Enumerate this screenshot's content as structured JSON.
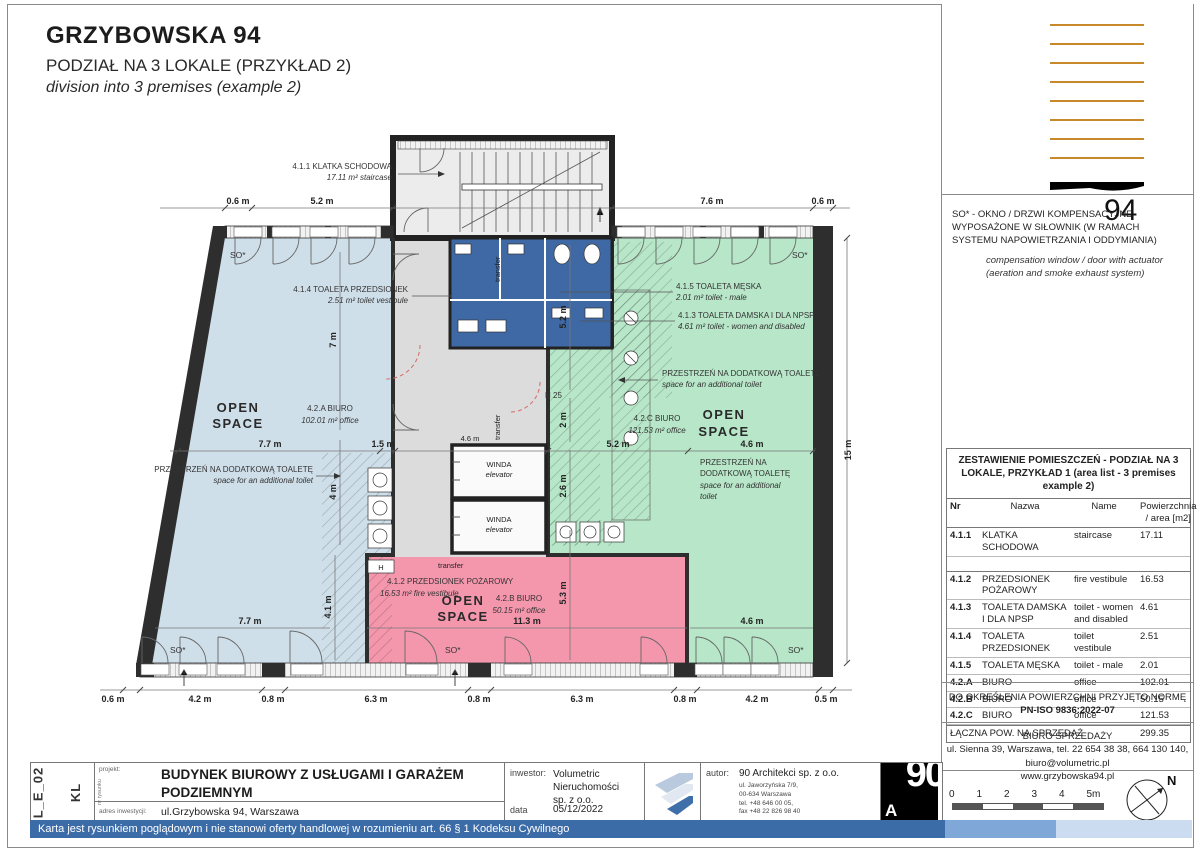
{
  "title": {
    "main": "GRZYBOWSKA 94",
    "sub_pl": "PODZIAŁ NA 3 LOKALE (PRZYKŁAD 2)",
    "sub_en": "division into 3 premises (example 2)"
  },
  "logo94": {
    "number": "94"
  },
  "so_note": {
    "pl": "SO* - OKNO / DRZWI KOMPENSACYJNE WYPOSAŻONE W SIŁOWNIK (W RAMACH SYSTEMU NAPOWIETRZANIA I ODDYMIANIA)",
    "en": "compensation window / door with actuator (aeration and smoke exhaust system)"
  },
  "area_table": {
    "title": "ZESTAWIENIE POMIESZCZEŃ - PODZIAŁ NA 3 LOKALE, PRZYKŁAD 1 (area list - 3 premises example 2)",
    "headers": {
      "nr": "Nr",
      "nazwa": "Nazwa",
      "name": "Name",
      "area": "Powierzchnia / area [m2]"
    },
    "rows": [
      {
        "nr": "4.1.1",
        "nazwa": "KLATKA SCHODOWA",
        "name": "staircase",
        "area": "17.11"
      },
      {
        "nr": "4.1.2",
        "nazwa": "PRZEDSIONEK POŻAROWY",
        "name": "fire vestibule",
        "area": "16.53"
      },
      {
        "nr": "4.1.3",
        "nazwa": "TOALETA DAMSKA I DLA NPSP",
        "name": "toilet - women and disabled",
        "area": "4.61"
      },
      {
        "nr": "4.1.4",
        "nazwa": "TOALETA PRZEDSIONEK",
        "name": "toilet vestibule",
        "area": "2.51"
      },
      {
        "nr": "4.1.5",
        "nazwa": "TOALETA MĘSKA",
        "name": "toilet - male",
        "area": "2.01"
      },
      {
        "nr": "4.2.A",
        "nazwa": "BIURO",
        "name": "office",
        "area": "102.01"
      },
      {
        "nr": "4.2.B",
        "nazwa": "BIURO",
        "name": "office",
        "area": "50.15"
      },
      {
        "nr": "4.2.C",
        "nazwa": "BIURO",
        "name": "office",
        "area": "121.53"
      }
    ],
    "total_label": "ŁĄCZNA POW. NA SPRZEDAŻ",
    "total_value": "299.35"
  },
  "norm_note": {
    "l1": "DO OKREŚLENIA POWIERZCHNI PRZYJĘTO NORMĘ",
    "l2": "PN-ISO 9836:2022-07"
  },
  "sales_office": {
    "l1": "BIURO SPRZEDAŻY",
    "l2": "ul. Sienna 39, Warszawa, tel. 22 654 38 38, 664 130 140,",
    "l3": "biuro@volumetric.pl",
    "l4": "www.grzybowska94.pl"
  },
  "scalebar": {
    "t0": "0",
    "t1": "1",
    "t2": "2",
    "t3": "3",
    "t4": "4",
    "t5": "5m"
  },
  "north_label": "N",
  "titleblock": {
    "code_drawing": "L_E_02",
    "code_floor": "KL",
    "code_tiny": "nr rysunku",
    "project_label": "projekt:",
    "project_l1": "BUDYNEK BIUROWY Z USŁUGAMI I GARAŻEM",
    "project_l2": "PODZIEMNYM",
    "address_label": "adres inwestycji:",
    "address": "ul.Grzybowska 94, Warszawa",
    "investor_label": "inwestor:",
    "investor_l1": "Volumetric",
    "investor_l2": "Nieruchomości",
    "investor_l3": "sp. z o.o.",
    "date_label": "data",
    "date": "05/12/2022",
    "author_label": "autor:",
    "author": "90 Architekci sp. z o.o.",
    "author_addr_l1": "ul. Jaworzyńska 7/9,",
    "author_addr_l2": "00-634 Warszawa",
    "author_addr_l3": "tel.  +48 646 00 05,",
    "author_addr_l4": "fax +48 22 826 98 40",
    "logo90_top": "90",
    "logo90_a": "A"
  },
  "disclaimer": "Karta jest rysunkiem poglądowym i nie stanowi oferty handlowej w rozumieniu art. 66 § 1 Kodeksu Cywilnego",
  "plan": {
    "labels": {
      "so": "SO*",
      "open": "OPEN",
      "space": "SPACE",
      "winda": "WINDA",
      "elevator": "elevator",
      "transfer": "transfer",
      "h25": "H 25",
      "h": "H",
      "st1": "4.1.1  KLATKA SCHODOWA",
      "st2": "17.11 m²  staircase",
      "tp1": "4.1.4  TOALETA PRZEDSIONEK",
      "tp2": "2.51 m²  toilet vestibule",
      "tm1": "4.1.5  TOALETA MĘSKA",
      "tm2": "2.01 m²  toilet - male",
      "td1": "4.1.3  TOALETA DAMSKA I DLA NPSP",
      "td2": "4.61 m²  toilet - women and disabled",
      "pp1": "4.1.2  PRZEDSIONEK POŻAROWY",
      "pp2": "16.53 m²  fire vestibule",
      "ba1": "4.2.A  BIURO",
      "ba2": "102.01 m²  office",
      "bb1": "4.2.B  BIURO",
      "bb2": "50.15 m²  office",
      "bc1": "4.2.C  BIURO",
      "bc2": "121.53 m²  office",
      "ex1": "PRZESTRZEŃ NA DODATKOWĄ TOALETĘ",
      "ex2": "space for an additional toilet",
      "exr1": "PRZESTRZEŃ NA",
      "exr2": "DODATKOWĄ TOALETĘ",
      "exr3": "space for an additional",
      "exr4": "toilet"
    },
    "dims": {
      "t06a": "0.6 m",
      "t52": "5.2 m",
      "t76": "7.6 m",
      "t06b": "0.6 m",
      "b06": "0.6 m",
      "b42a": "4.2 m",
      "b08a": "0.8 m",
      "b63a": "6.3 m",
      "b08b": "0.8 m",
      "b63b": "6.3 m",
      "b08c": "0.8 m",
      "b42b": "4.2 m",
      "b05": "0.5 m",
      "r15": "15 m",
      "m77": "7.7 m",
      "m15": "1.5 m",
      "m46a": "4.6 m",
      "m52": "5.2 m",
      "m46b": "4.6 m",
      "l77": "7.7 m",
      "l113": "11.3 m",
      "l46": "4.6 m",
      "v7": "7 m",
      "v4": "4 m",
      "v41": "4.1 m",
      "v52": "5.2 m",
      "v2": "2 m",
      "v26": "2.6 m",
      "v53": "5.3 m"
    }
  }
}
